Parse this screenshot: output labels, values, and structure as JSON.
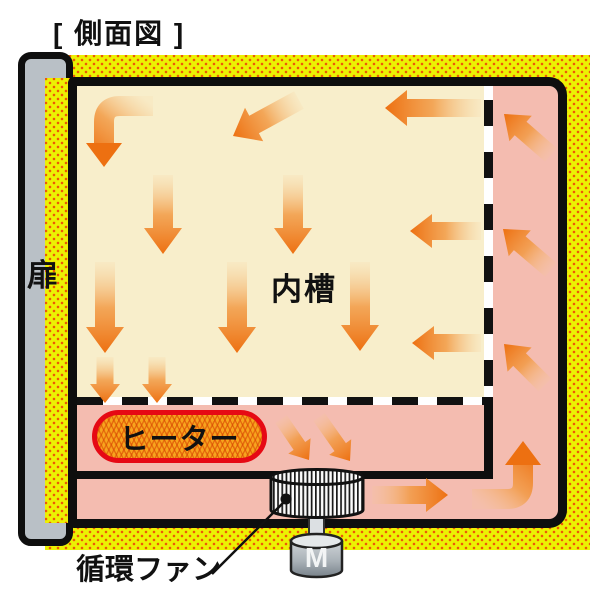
{
  "title": "[ 側面図 ]",
  "labels": {
    "door": "扉",
    "inner_chamber": "内槽",
    "heater": "ヒーター",
    "circulation_fan": "循環ファン",
    "motor": "M"
  },
  "colors": {
    "insulation_yellow": "#ecf103",
    "insulation_dot": "#ee5907",
    "cabinet_pink": "#f4bcb0",
    "chamber_cream": "#f8eecb",
    "door_gray": "#b9c0c6",
    "heater_fill": "#f7a41d",
    "heater_border": "#e60914",
    "outline_black": "#111111",
    "arrow_head": "#ed7011",
    "arrow_mid": "#f29a44",
    "arrow_tail": "#f6c98e"
  },
  "airflow": {
    "arrows": [
      {
        "name": "chamber-down-a1",
        "x1": 163,
        "y1": 175,
        "x2": 163,
        "y2": 254,
        "w": 20,
        "hw": 38,
        "hl": 26
      },
      {
        "name": "chamber-down-a2",
        "x1": 293,
        "y1": 175,
        "x2": 293,
        "y2": 254,
        "w": 20,
        "hw": 38,
        "hl": 26
      },
      {
        "name": "chamber-down-b1",
        "x1": 105,
        "y1": 262,
        "x2": 105,
        "y2": 353,
        "w": 20,
        "hw": 38,
        "hl": 26
      },
      {
        "name": "chamber-down-b2",
        "x1": 237,
        "y1": 262,
        "x2": 237,
        "y2": 353,
        "w": 20,
        "hw": 38,
        "hl": 26
      },
      {
        "name": "chamber-down-b3",
        "x1": 360,
        "y1": 262,
        "x2": 360,
        "y2": 351,
        "w": 20,
        "hw": 38,
        "hl": 26
      },
      {
        "name": "outlet-down-1",
        "x1": 105,
        "y1": 357,
        "x2": 105,
        "y2": 403,
        "w": 17,
        "hw": 30,
        "hl": 19
      },
      {
        "name": "outlet-down-2",
        "x1": 157,
        "y1": 357,
        "x2": 157,
        "y2": 403,
        "w": 17,
        "hw": 30,
        "hl": 19
      },
      {
        "name": "inlet-left-top",
        "x1": 481,
        "y1": 108,
        "x2": 385,
        "y2": 108,
        "w": 18,
        "hw": 36,
        "hl": 22
      },
      {
        "name": "inlet-left-mid",
        "x1": 481,
        "y1": 231,
        "x2": 410,
        "y2": 231,
        "w": 18,
        "hw": 34,
        "hl": 22
      },
      {
        "name": "inlet-left-low",
        "x1": 481,
        "y1": 343,
        "x2": 412,
        "y2": 343,
        "w": 18,
        "hw": 34,
        "hl": 22
      },
      {
        "name": "top-diagonal",
        "x1": 299,
        "y1": 100,
        "x2": 233,
        "y2": 136,
        "w": 20,
        "hw": 38,
        "hl": 24
      },
      {
        "name": "plenum-up-1",
        "x1": 551,
        "y1": 155,
        "x2": 504,
        "y2": 114,
        "w": 18,
        "hw": 34,
        "hl": 22
      },
      {
        "name": "plenum-up-2",
        "x1": 551,
        "y1": 270,
        "x2": 503,
        "y2": 229,
        "w": 18,
        "hw": 34,
        "hl": 22
      },
      {
        "name": "plenum-up-3",
        "x1": 545,
        "y1": 385,
        "x2": 504,
        "y2": 344,
        "w": 18,
        "hw": 34,
        "hl": 22
      },
      {
        "name": "fan-in-1",
        "x1": 281,
        "y1": 419,
        "x2": 309,
        "y2": 460,
        "w": 14,
        "hw": 27,
        "hl": 17
      },
      {
        "name": "fan-in-2",
        "x1": 319,
        "y1": 417,
        "x2": 350,
        "y2": 461,
        "w": 14,
        "hw": 27,
        "hl": 17
      },
      {
        "name": "duct-right",
        "x1": 372,
        "y1": 495,
        "x2": 448,
        "y2": 495,
        "w": 18,
        "hw": 34,
        "hl": 22
      }
    ],
    "elbows": [
      {
        "name": "top-left-elbow",
        "tail": [
          153,
          106
        ],
        "corner": [
          104,
          106
        ],
        "tip": [
          104,
          167
        ],
        "w": 20,
        "hw": 36,
        "hl": 24,
        "r": 16
      },
      {
        "name": "bottom-right-elbow",
        "tail": [
          472,
          499
        ],
        "corner": [
          523,
          499
        ],
        "tip": [
          523,
          441
        ],
        "w": 20,
        "hw": 36,
        "hl": 24,
        "r": 16
      }
    ]
  }
}
